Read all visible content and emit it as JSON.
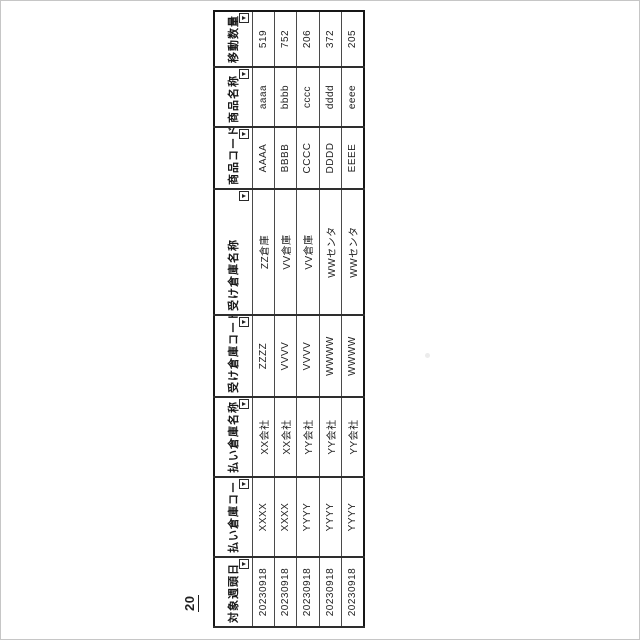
{
  "page": {
    "figure_label": "20",
    "background_color": "#ffffff",
    "ink_color": "#1f1f1f",
    "orientation_note": "landscape table rotated 90deg counterclockwise on portrait scan"
  },
  "table": {
    "columns": [
      {
        "label": "対象週頭日",
        "filter_icon": "filter-dropdown"
      },
      {
        "label": "払い倉庫コード",
        "filter_icon": "filter-dropdown"
      },
      {
        "label": "払い倉庫名称",
        "filter_icon": "filter-dropdown"
      },
      {
        "label": "受け倉庫コード",
        "filter_icon": "filter-dropdown"
      },
      {
        "label": "受け倉庫名称",
        "filter_icon": "filter-dropdown"
      },
      {
        "label": "商品コード",
        "filter_icon": "filter-dropdown"
      },
      {
        "label": "商品名称",
        "filter_icon": "filter-dropdown"
      },
      {
        "label": "移動数量",
        "filter_icon": "filter-dropdown"
      }
    ],
    "rows": [
      [
        "20230918",
        "XXXX",
        "XX会社",
        "ZZZZ",
        "ZZ倉庫",
        "AAAA",
        "aaaa",
        "519"
      ],
      [
        "20230918",
        "XXXX",
        "XX会社",
        "VVVV",
        "VV倉庫",
        "BBBB",
        "bbbb",
        "752"
      ],
      [
        "20230918",
        "YYYY",
        "YY会社",
        "VVVV",
        "VV倉庫",
        "CCCC",
        "cccc",
        "206"
      ],
      [
        "20230918",
        "YYYY",
        "YY会社",
        "WWWW",
        "WWセンタ",
        "DDDD",
        "dddd",
        "372"
      ],
      [
        "20230918",
        "YYYY",
        "YY会社",
        "WWWW",
        "WWセンタ",
        "EEEE",
        "eeee",
        "205"
      ]
    ]
  }
}
